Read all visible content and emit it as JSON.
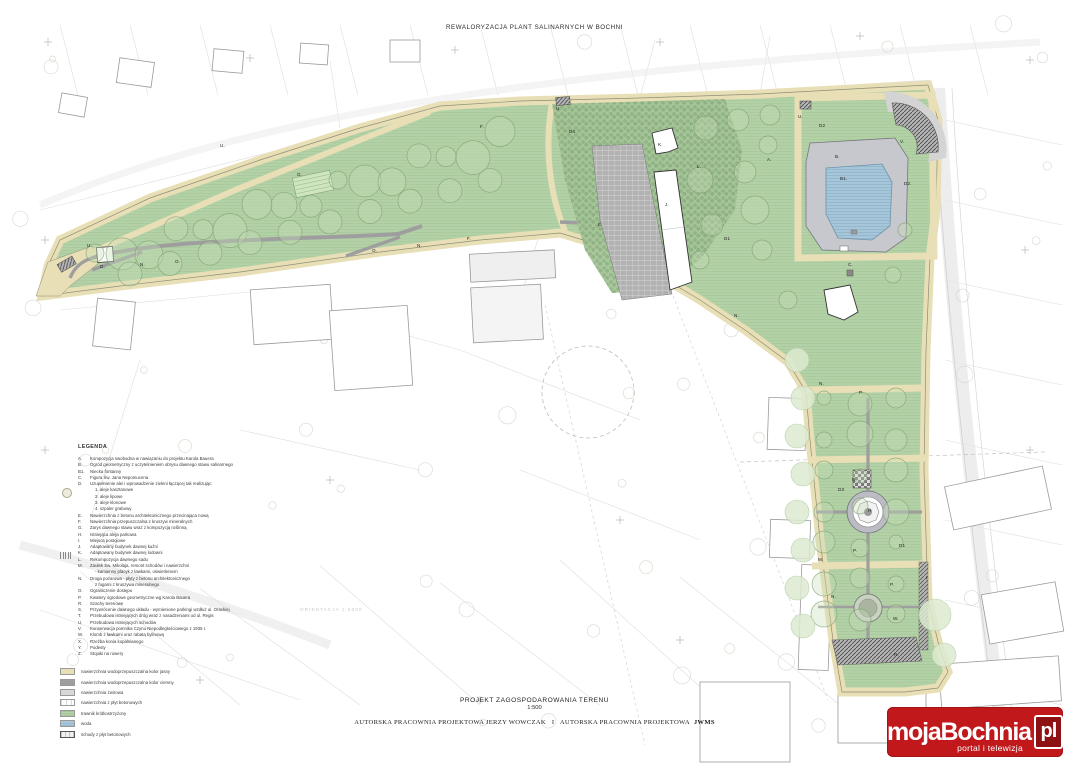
{
  "header": {
    "title": "REWALORYZACJA PLANT SALINARNYCH W BOCHNI"
  },
  "watermark": {
    "text": "ORIENTACJA 1:5000"
  },
  "footer": {
    "title": "PROJEKT ZAGOSPODAROWANIA TERENU",
    "scale": "1:500",
    "credit_left": "AUTORSKA PRACOWNIA PROJEKTOWA JERZY WOWCZAK",
    "credit_sep": "I",
    "credit_right": "AUTORSKA PRACOWNIA PROJEKTOWA",
    "credit_bold": "JWMS"
  },
  "logo": {
    "name": "mojaBochnia",
    "tld": "pl",
    "tagline": "portal i telewizja",
    "bg_color": "#c0181b",
    "tld_bg": "#8e1114"
  },
  "legend": {
    "title": "LEGENDA",
    "items": [
      {
        "key": "A.",
        "text": "Kompozycja swobodna w nawiązaniu do projektu Karola Bauera"
      },
      {
        "key": "B.",
        "text": "Ogród geometryczny z uczytelnieniem obrysu dawnego stawu salinarnego"
      },
      {
        "key": "B1.",
        "text": "Niecka fontanny"
      },
      {
        "key": "C.",
        "text": "Figura Św. Jana Nepomucena"
      },
      {
        "key": "D.",
        "text": "Uzupełnienie alei i wprowadzenie zieleni łączącej tak realizując:",
        "subs": [
          "1. aleje kasztanowe",
          "2. aleje lipowe",
          "3. aleje klonowe",
          "4. szpaler grabowy"
        ]
      },
      {
        "key": "E.",
        "text": "Nawierzchnia z betonu architektonicznego przecinająca nową"
      },
      {
        "key": "F.",
        "text": "Nawierzchnia przepuszczalna z kruszyw mineralnych"
      },
      {
        "key": "G.",
        "text": "Zarys dawnego stawu wraz z kompozycją roślinną"
      },
      {
        "key": "H.",
        "text": "Istniejąca aleja parkowa"
      },
      {
        "key": "I.",
        "text": "Miejsca postojowe"
      },
      {
        "key": "J.",
        "text": "Adaptowany budynek dawnej kuźni"
      },
      {
        "key": "K.",
        "text": "Adaptowany budynek dawnej lodowni"
      },
      {
        "key": "L.",
        "text": "Rekompozycja dawnego sadu"
      },
      {
        "key": "M.",
        "text": "Zaułek Św. Mikołaja, remont schodów i nawierzchni",
        "subs": [
          "- kamienny placyk z ławkami, oświetleniem"
        ]
      },
      {
        "key": "N.",
        "text": "Droga pożarowa - płyty z betonu architektonicznego",
        "subs": [
          "z fugami z kruszywa mineralnego"
        ]
      },
      {
        "key": "O.",
        "text": "Ograniczenie dostępu"
      },
      {
        "key": "P.",
        "text": "Kwatery ogrodowe geometryczne wg Karola Bauera"
      },
      {
        "key": "R.",
        "text": "Szachy terenowe"
      },
      {
        "key": "S.",
        "text": "Przywrócenie dawnego układu - wymienione parkingi wzdłuż ul. Orackiej"
      },
      {
        "key": "T.",
        "text": "Przebudowa istniejących dróg wraz z nasadzeniami od ul. Regis"
      },
      {
        "key": "U.",
        "text": "Przebudowa istniejących schodów"
      },
      {
        "key": "V.",
        "text": "Konserwacja pomnika Czynu Niepodległościowego z 1935 r."
      },
      {
        "key": "W.",
        "text": "Klomb z ławkami oraz rabatą bylinową"
      },
      {
        "key": "X.",
        "text": "Rzeźba konia kopalnianego"
      },
      {
        "key": "Y.",
        "text": "Podesty"
      },
      {
        "key": "Z.",
        "text": "Stojaki na rowery"
      }
    ],
    "swatches": [
      {
        "type": "tan",
        "label": "nawierzchnia wodoprzepuszczalna kolor jasny"
      },
      {
        "type": "darkgray",
        "label": "nawierzchnia wodoprzepuszczalna kolor ciemny"
      },
      {
        "type": "gray",
        "label": "nawierzchnia żwirowa"
      },
      {
        "type": "plates",
        "label": "nawierzchnia z płyt betonowych"
      },
      {
        "type": "grass",
        "label": "trawnik krótkostrzyżony"
      },
      {
        "type": "water",
        "label": "woda"
      },
      {
        "type": "stairs",
        "label": "schody z płyt betonowych"
      }
    ]
  },
  "plan_labels": [
    {
      "t": "U.",
      "x": 556,
      "y": 106
    },
    {
      "t": "U.",
      "x": 798,
      "y": 114
    },
    {
      "t": "U.",
      "x": 220,
      "y": 143
    },
    {
      "t": "U.",
      "x": 87,
      "y": 243
    },
    {
      "t": "D4",
      "x": 569,
      "y": 129
    },
    {
      "t": "F.",
      "x": 480,
      "y": 124
    },
    {
      "t": "G.",
      "x": 297,
      "y": 172
    },
    {
      "t": "K.",
      "x": 658,
      "y": 142
    },
    {
      "t": "L.",
      "x": 697,
      "y": 164
    },
    {
      "t": "J.",
      "x": 665,
      "y": 202
    },
    {
      "t": "E.",
      "x": 598,
      "y": 222
    },
    {
      "t": "D1",
      "x": 724,
      "y": 236
    },
    {
      "t": "A.",
      "x": 767,
      "y": 157
    },
    {
      "t": "B.",
      "x": 835,
      "y": 154
    },
    {
      "t": "B1.",
      "x": 840,
      "y": 176
    },
    {
      "t": "D2",
      "x": 819,
      "y": 123
    },
    {
      "t": "D2.",
      "x": 904,
      "y": 181
    },
    {
      "t": "V.",
      "x": 900,
      "y": 139
    },
    {
      "t": "C.",
      "x": 848,
      "y": 262
    },
    {
      "t": "N.",
      "x": 734,
      "y": 313
    },
    {
      "t": "D.",
      "x": 100,
      "y": 264
    },
    {
      "t": "N.",
      "x": 140,
      "y": 262
    },
    {
      "t": "O.",
      "x": 175,
      "y": 259
    },
    {
      "t": "O.",
      "x": 372,
      "y": 248
    },
    {
      "t": "N.",
      "x": 417,
      "y": 243
    },
    {
      "t": "F.",
      "x": 467,
      "y": 236
    },
    {
      "t": "N.",
      "x": 819,
      "y": 381
    },
    {
      "t": "P.",
      "x": 859,
      "y": 390
    },
    {
      "t": "R.",
      "x": 852,
      "y": 477
    },
    {
      "t": "D3",
      "x": 838,
      "y": 487
    },
    {
      "t": "H",
      "x": 868,
      "y": 508
    },
    {
      "t": "D1",
      "x": 899,
      "y": 543
    },
    {
      "t": "P.",
      "x": 853,
      "y": 548
    },
    {
      "t": "M.",
      "x": 818,
      "y": 557
    },
    {
      "t": "P.",
      "x": 890,
      "y": 582
    },
    {
      "t": "N.",
      "x": 831,
      "y": 594
    },
    {
      "t": "I.",
      "x": 926,
      "y": 575
    },
    {
      "t": "W.",
      "x": 893,
      "y": 616
    },
    {
      "t": "N.",
      "x": 894,
      "y": 652
    }
  ]
}
